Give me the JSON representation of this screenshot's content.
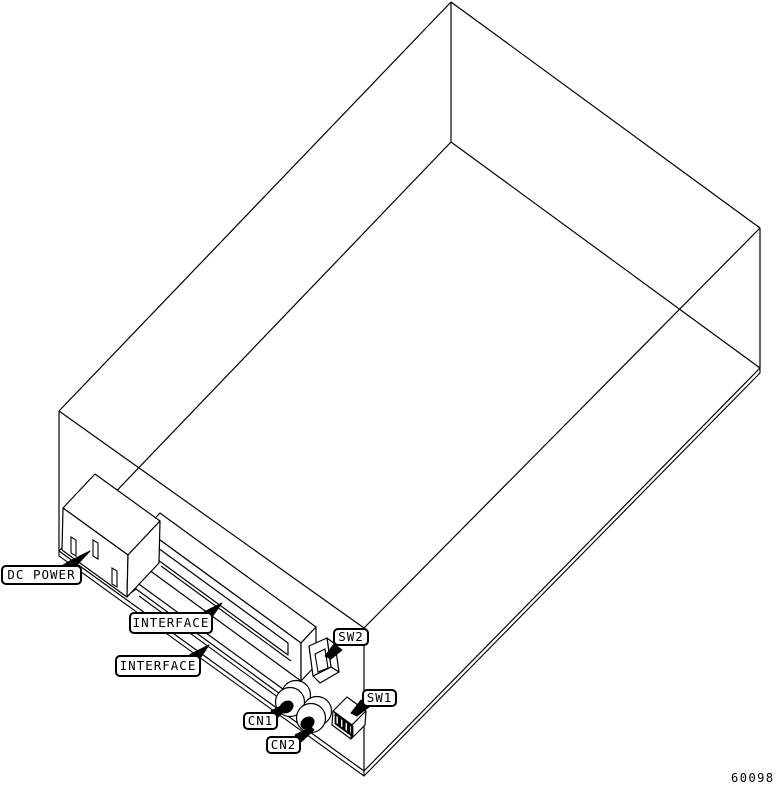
{
  "diagram": {
    "figure_number": "60098",
    "colors": {
      "line": "#000000",
      "background": "#ffffff"
    },
    "callouts": {
      "dc_power": {
        "text": "DC POWER"
      },
      "interface_1": {
        "text": "INTERFACE"
      },
      "interface_2": {
        "text": "INTERFACE"
      },
      "sw2": {
        "text": "SW2"
      },
      "sw1": {
        "text": "SW1"
      },
      "cn1": {
        "text": "CN1"
      },
      "cn2": {
        "text": "CN2"
      }
    }
  }
}
